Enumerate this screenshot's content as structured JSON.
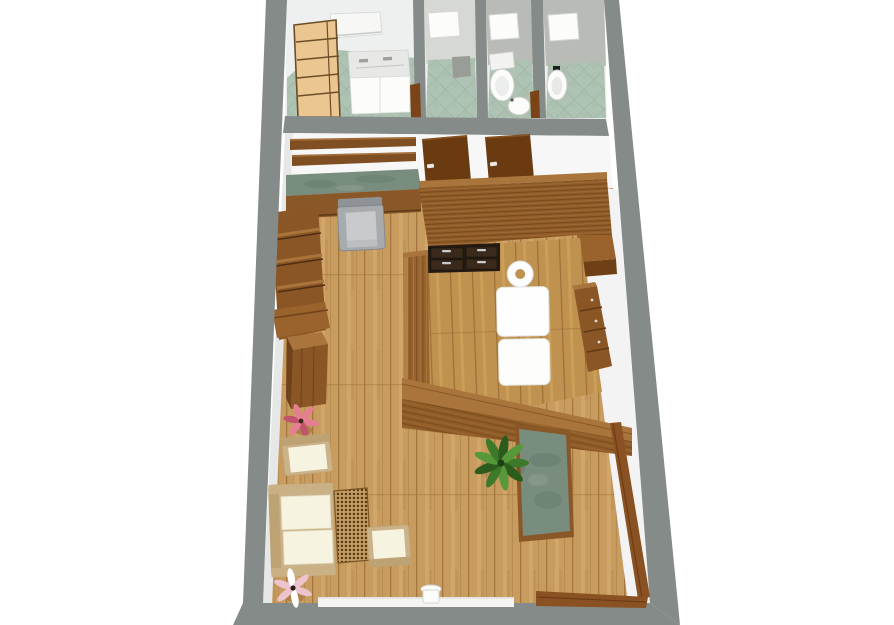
{
  "scene": {
    "title": "3D floor plan render",
    "style": "top-down dollhouse perspective, no visible text",
    "background": "#ffffff"
  },
  "palette": {
    "wallGray": "#858b89",
    "wallFaceWhite": "#f6f7f6",
    "rightFaceWhite": "#f2f3f2",
    "stallWallGray": "#b9bbb6",
    "hallWallGray": "#d6d8d4",
    "tileGreen": "#aec3b3",
    "tileLine": "#94aa99",
    "woodFloor": "#c89c5f",
    "woodFloorLine": "#a3773e",
    "woodFloorHi": "#d7ae73",
    "woodFloorMassage": "#c0924f",
    "saunaWood": "#8f5c28",
    "saunaLine": "#6b3f16",
    "saunaHi": "#a5713a",
    "doorBrown": "#6a3a10",
    "shelfBrown": "#7f4e22",
    "midWood": "#96632f",
    "topFaceWood": "#a9753c",
    "greenStone": "#798d7e",
    "greenStoneDark": "#64776a",
    "cream": "#f6f3e0",
    "tanFrame": "#cbb289",
    "tanFrameDark": "#bda374",
    "grayChair": "#a7abae",
    "grayChairSeat": "#c8cacc",
    "grayChairBack": "#8f9396",
    "rattan": "#c09a60",
    "rattanDot": "#573517",
    "plantGreen": "#3c7a2a",
    "plantGreenDark": "#2b5c1b",
    "plantGreenLight": "#57983a",
    "flowerPink": "#e67e92",
    "flowerPinkDark": "#c2526d",
    "flowerPalePink": "#edc3cd",
    "ladderBeige": "#ecc690",
    "ladderLine": "#6b4d28",
    "fixtureWhite": "#fcfcfb",
    "fixtureShadow": "#d6d8d5",
    "drawerDark": "#241a12",
    "drawerFace": "#3a2a1b",
    "handleSilver": "#c9ccce"
  },
  "rooms": [
    {
      "id": "utility-room",
      "label": "utility room with ladder shelf and double-sink cabinet",
      "floor": "green tile"
    },
    {
      "id": "shower-stall",
      "label": "shower stall",
      "floor": "green tile"
    },
    {
      "id": "wc-1",
      "label": "WC with toilet and corner sink",
      "floor": "green tile"
    },
    {
      "id": "wc-2",
      "label": "WC with bidet",
      "floor": "green tile"
    },
    {
      "id": "studio",
      "label": "main studio room",
      "floor": "oak plank"
    },
    {
      "id": "massage-area",
      "label": "massage area enclosed by wooden partition walls",
      "floor": "oak plank"
    }
  ],
  "furniture": [
    {
      "id": "ladder-shelf",
      "label": "beige ladder shelf"
    },
    {
      "id": "wall-cabinet",
      "label": "white wall cabinet"
    },
    {
      "id": "sink-cabinet",
      "label": "white cabinet with double sink"
    },
    {
      "id": "toilet",
      "label": "toilet"
    },
    {
      "id": "corner-sink",
      "label": "small corner sink"
    },
    {
      "id": "bidet",
      "label": "bidet"
    },
    {
      "id": "wall-shelves",
      "label": "two wooden wall shelves"
    },
    {
      "id": "green-top-sideboard",
      "label": "sideboard with green stone top"
    },
    {
      "id": "gray-armchair",
      "label": "gray armchair"
    },
    {
      "id": "wc-door-1",
      "label": "open wooden door"
    },
    {
      "id": "wc-door-2",
      "label": "open wooden door"
    },
    {
      "id": "slatted-partition",
      "label": "tall slatted wooden partition wall"
    },
    {
      "id": "drawer-unit",
      "label": "dark drawer unit with metal handles"
    },
    {
      "id": "massage-table",
      "label": "white massage table with face hole"
    },
    {
      "id": "dresser",
      "label": "wooden dresser"
    },
    {
      "id": "side-cabinet",
      "label": "wooden side cabinet"
    },
    {
      "id": "bookshelf",
      "label": "wooden bookshelf"
    },
    {
      "id": "wooden-cabinet",
      "label": "small wooden cabinet"
    },
    {
      "id": "reception-desk",
      "label": "desk with green stone top"
    },
    {
      "id": "potted-plant",
      "label": "green potted plant"
    },
    {
      "id": "pink-flower-1",
      "label": "pink flower plant"
    },
    {
      "id": "armchair-1",
      "label": "cream armchair"
    },
    {
      "id": "sofa",
      "label": "cream two-seat sofa"
    },
    {
      "id": "rattan-coffee-table",
      "label": "rattan coffee table"
    },
    {
      "id": "armchair-2",
      "label": "cream armchair"
    },
    {
      "id": "pink-flower-2",
      "label": "pale pink flower plant"
    },
    {
      "id": "white-stool",
      "label": "small white stool"
    },
    {
      "id": "glass-door-frame",
      "label": "wooden door frame at entrance"
    },
    {
      "id": "entrance-threshold",
      "label": "white entrance threshold"
    }
  ]
}
